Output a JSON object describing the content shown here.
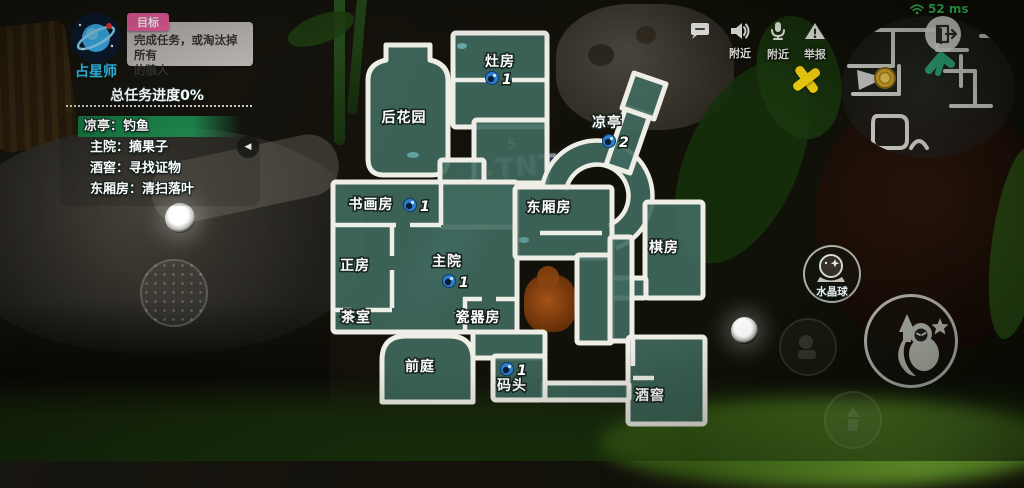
{
  "colors": {
    "accent_pink": "#ef5f9f",
    "task_highlight_green": "#1e9152",
    "ping_green": "#3ecf63",
    "map_teal": "#406a5f",
    "map_wall": "#efeee6",
    "marker_yellow": "#ffd911",
    "avatar_blue": "#35c3f5",
    "eye_blue": "#2e7fd2"
  },
  "player": {
    "role": "占星师",
    "avatar_icon": "astrologer-planet-icon"
  },
  "objective": {
    "badge": "目标",
    "line1": "完成任务，或淘汰掉所有",
    "line2": "的狼人"
  },
  "progress": {
    "text": "总任务进度0%"
  },
  "task_panel": {
    "tasks": [
      {
        "text": "凉亭：钓鱼",
        "highlighted": true,
        "arrow": "<"
      },
      {
        "text": "主院：摘果子"
      },
      {
        "text": "酒窖：寻找证物"
      },
      {
        "text": "东厢房：清扫落叶"
      }
    ],
    "collapse_icon": "◀"
  },
  "top_right": {
    "chat_icon": "chat-bubble-icon",
    "controls": [
      {
        "icon": "speaker-icon",
        "label": "附近"
      },
      {
        "icon": "mic-icon",
        "label": "附近"
      },
      {
        "icon": "report-icon",
        "label": "举报"
      }
    ],
    "ping": "52 ms",
    "ping_icon": "wifi-icon",
    "exit_icon": "door-exit-icon"
  },
  "minimap": {
    "markers": [
      "coin-icon",
      "player-arrow-icon"
    ]
  },
  "map": {
    "marker": "x-mark",
    "rooms": [
      {
        "name": "灶房",
        "count": "1"
      },
      {
        "name": "后花园"
      },
      {
        "name": "凉亭",
        "count": "2"
      },
      {
        "name": "书画房",
        "count": "1"
      },
      {
        "name": "东厢房"
      },
      {
        "name": "棋房"
      },
      {
        "name": "正房"
      },
      {
        "name": "主院",
        "count": "1"
      },
      {
        "name": "茶室"
      },
      {
        "name": "瓷器房"
      },
      {
        "name": "前庭"
      },
      {
        "name": "码头",
        "count": "1"
      },
      {
        "name": "酒窖"
      }
    ]
  },
  "abilities": {
    "crystal_ball_label": "水晶球",
    "crystal_ball_icon": "crystal-ball-icon",
    "main_icon": "ninja-character-icon"
  },
  "scene": {
    "billboard_small": "5",
    "billboard": "TNT",
    "billboard_star": "✦"
  }
}
